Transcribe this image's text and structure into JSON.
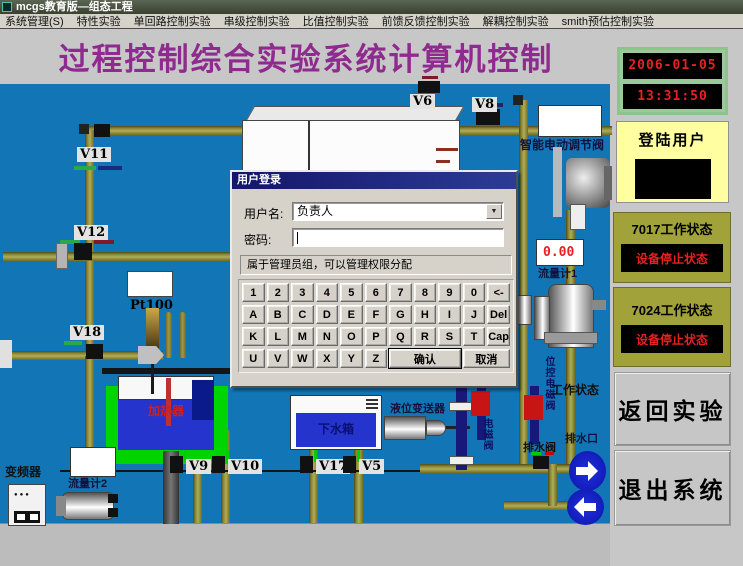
{
  "window": {
    "title": "mcgs教育版—组态工程"
  },
  "menu": {
    "items": [
      "系统管理(S)",
      "特性实验",
      "单回路控制实验",
      "串级控制实验",
      "比值控制实验",
      "前馈反馈控制实验",
      "解耦控制实验",
      "smith预估控制实验"
    ]
  },
  "header": {
    "title": "过程控制综合实验系统计算机控制"
  },
  "side": {
    "date": "2006-01-05",
    "time": "13:31:50",
    "login_title": "登陆用户",
    "s7017_title": "7017工作状态",
    "s7017_status": "设备停止状态",
    "s7024_title": "7024工作状态",
    "s7024_status": "设备停止状态",
    "back": "返回实验",
    "exit": "退出系统"
  },
  "dialog": {
    "title": "用户登录",
    "username_label": "用户名:",
    "username_value": "负责人",
    "password_label": "密码:",
    "password_value": "",
    "hint": "属于管理员组，可以管理权限分配",
    "keys": [
      "1",
      "2",
      "3",
      "4",
      "5",
      "6",
      "7",
      "8",
      "9",
      "0",
      "<-",
      "A",
      "B",
      "C",
      "D",
      "E",
      "F",
      "G",
      "H",
      "I",
      "J",
      "Del",
      "K",
      "L",
      "M",
      "N",
      "O",
      "P",
      "Q",
      "R",
      "S",
      "T",
      "Cap",
      "U",
      "V",
      "W",
      "X",
      "Y",
      "Z"
    ],
    "confirm": "确认",
    "cancel": "取消"
  },
  "diagram": {
    "valves": {
      "v11": "V11",
      "v12": "V12",
      "v18": "V18",
      "v6": "V6",
      "v8": "V8",
      "v9": "V9",
      "v10": "V10",
      "v17": "V17",
      "v5": "V5"
    },
    "smart_valve": "智能电动调节阀",
    "flow1_value": "0.00",
    "flow1": "流量计1",
    "pt100": "Pt100",
    "heater": "加热器",
    "inverter": "变频器",
    "flow2": "流量计2",
    "lower_tank": "下水箱",
    "level_transmitter": "液位变送器",
    "work_status": "工作状态",
    "solenoid_v1": "电磁阀",
    "solenoid_v2": "位控电磁阀",
    "drain_valve": "排水阀",
    "drain_outlet": "排水口"
  },
  "colors": {
    "bg_blue": "#1276b6",
    "pipe_olive": "#8f8c3a",
    "accent_purple": "#8f2a8f",
    "lcd_red": "#e82020",
    "panel_olive": "#a2a23a",
    "panel_yellow": "#ffffa2",
    "tank_green": "#00d400",
    "water_blue": "#2534cc"
  }
}
